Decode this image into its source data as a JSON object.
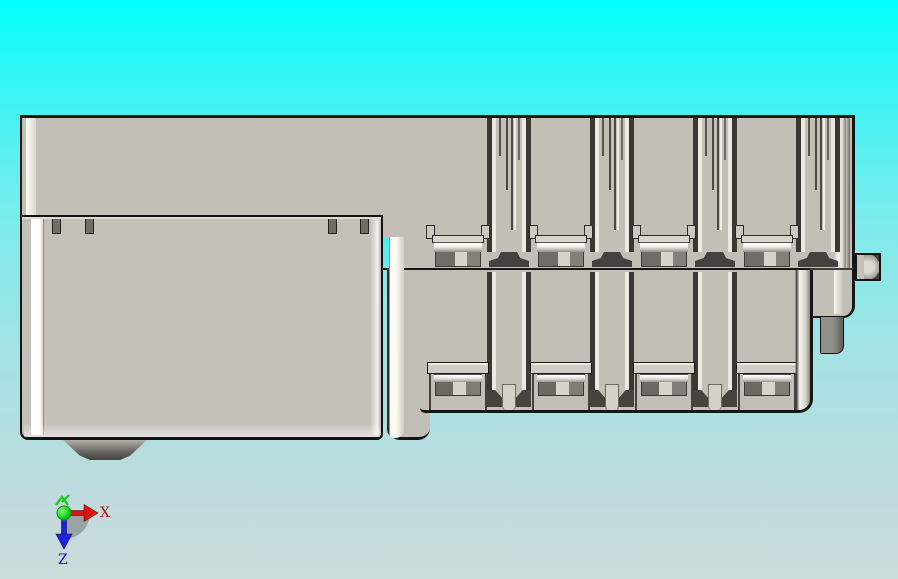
{
  "scene": {
    "type": "cad-viewport",
    "description": "Orthographic top view of a gray plastic DIN-rail terminal module in a CAD viewport over a cyan gradient background",
    "background_top_color": "#00FFFF",
    "background_bottom_color": "#CBDCDC"
  },
  "model": {
    "body_color": "#C1BFB6",
    "outline_color": "#161616",
    "highlight_color": "#FBFAF3",
    "slot_color": "#393833",
    "clamp_dark_color": "#6F6E68",
    "metal_band_top_color": "#FFFFFF",
    "metal_band_bottom_color": "#8F8E87",
    "features": {
      "mounting_tabs": 4,
      "terminal_modules": 4,
      "upper_terminal_pockets": 4,
      "lower_terminal_pockets": 4,
      "vertical_slot_channels": 4,
      "side_pegs": 1,
      "bottom_feet": 1
    }
  },
  "triad": {
    "x_axis": {
      "label": "X",
      "color": "#C01010",
      "direction": "right"
    },
    "y_axis": {
      "label": "",
      "color": "#12CC12",
      "direction": "out-of-screen"
    },
    "z_axis": {
      "label": "Z",
      "color": "#1212C8",
      "direction": "down"
    },
    "sector_color": "#6E6E6E"
  }
}
